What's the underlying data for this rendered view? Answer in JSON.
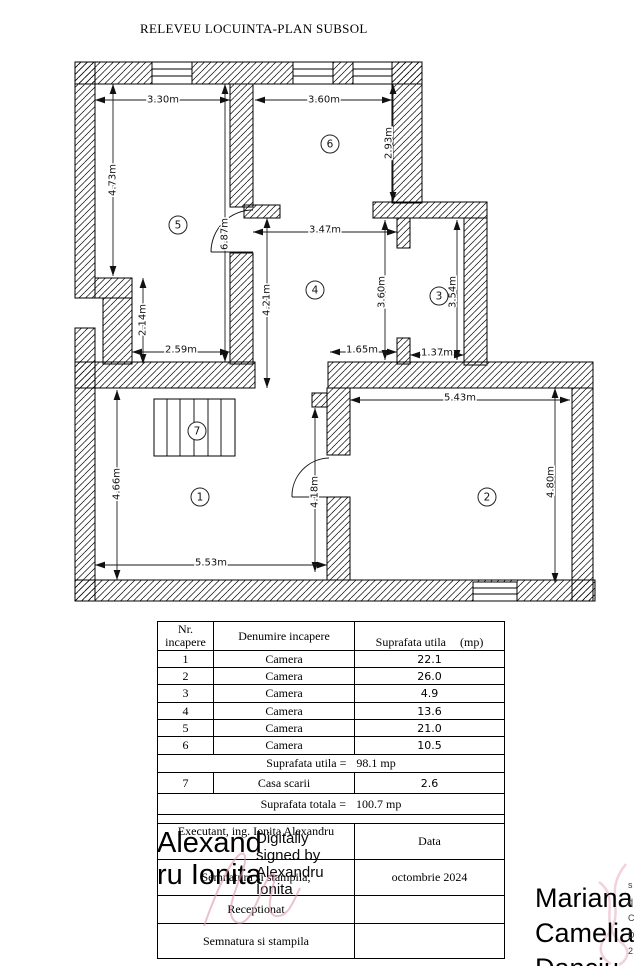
{
  "title": "RELEVEU LOCUINTA-PLAN SUBSOL",
  "plan": {
    "rooms": {
      "r1": "1",
      "r2": "2",
      "r3": "3",
      "r4": "4",
      "r5": "5",
      "r6": "6",
      "r7": "7"
    },
    "dims": {
      "r5_width": "3.30m",
      "r6_width": "3.60m",
      "r5_height": "4.73m",
      "r6_height": "2.93m",
      "hall_height": "6.87m",
      "r4_width": "3.47m",
      "r4_height": "4.21m",
      "r4_height_right": "3.60m",
      "r3_height": "3.54m",
      "step_height": "2.14m",
      "r5_lower_width": "2.59m",
      "passage_width": "1.65m",
      "r3_width": "1.37m",
      "r2_width": "5.43m",
      "r1_height": "4.66m",
      "door_wall_height": "4.18m",
      "r2_height": "4.80m",
      "r1_width": "5.53m"
    }
  },
  "table": {
    "headers": {
      "col1": "Nr.\nincapere",
      "col2": "Denumire incapere",
      "col3": "Suprafata utila",
      "col3_unit": "(mp)"
    },
    "rows": [
      {
        "nr": "1",
        "name": "Camera",
        "area": "22.1"
      },
      {
        "nr": "2",
        "name": "Camera",
        "area": "26.0"
      },
      {
        "nr": "3",
        "name": "Camera",
        "area": "4.9"
      },
      {
        "nr": "4",
        "name": "Camera",
        "area": "13.6"
      },
      {
        "nr": "5",
        "name": "Camera",
        "area": "21.0"
      },
      {
        "nr": "6",
        "name": "Camera",
        "area": "10.5"
      },
      {
        "nr": "7",
        "name": "Casa scarii",
        "area": "2.6"
      }
    ],
    "subtotal": {
      "label": "Suprafata utila =",
      "value": "98.1 mp"
    },
    "total": {
      "label": "Suprafata totala =",
      "value": "100.7 mp"
    }
  },
  "signature_block": {
    "executant_label": "Executant, ing. Ionita Alexandru",
    "data_label": "Data",
    "date_value": "octombrie 2024",
    "semnatura_label": "Semnatura si stampila,",
    "receptionat_label": "Receptionat",
    "semnatura2_label": "Semnatura si stampila",
    "digital_signature_line1": "Alexand",
    "digital_signature_line2": "ru Ionita",
    "digital_signature_note": "Digitally signed by Alexandru Ionita"
  },
  "stamp": {
    "name_line1": "Mariana",
    "name_line2": "Camelia",
    "name_line3": "Danciu",
    "edge_fragments": [
      "s",
      "d",
      "C",
      "D",
      "2"
    ]
  },
  "colors": {
    "line": "#000000",
    "signature_pink": "#dd9aa8",
    "ribbon_pink": "#efc6d2"
  }
}
